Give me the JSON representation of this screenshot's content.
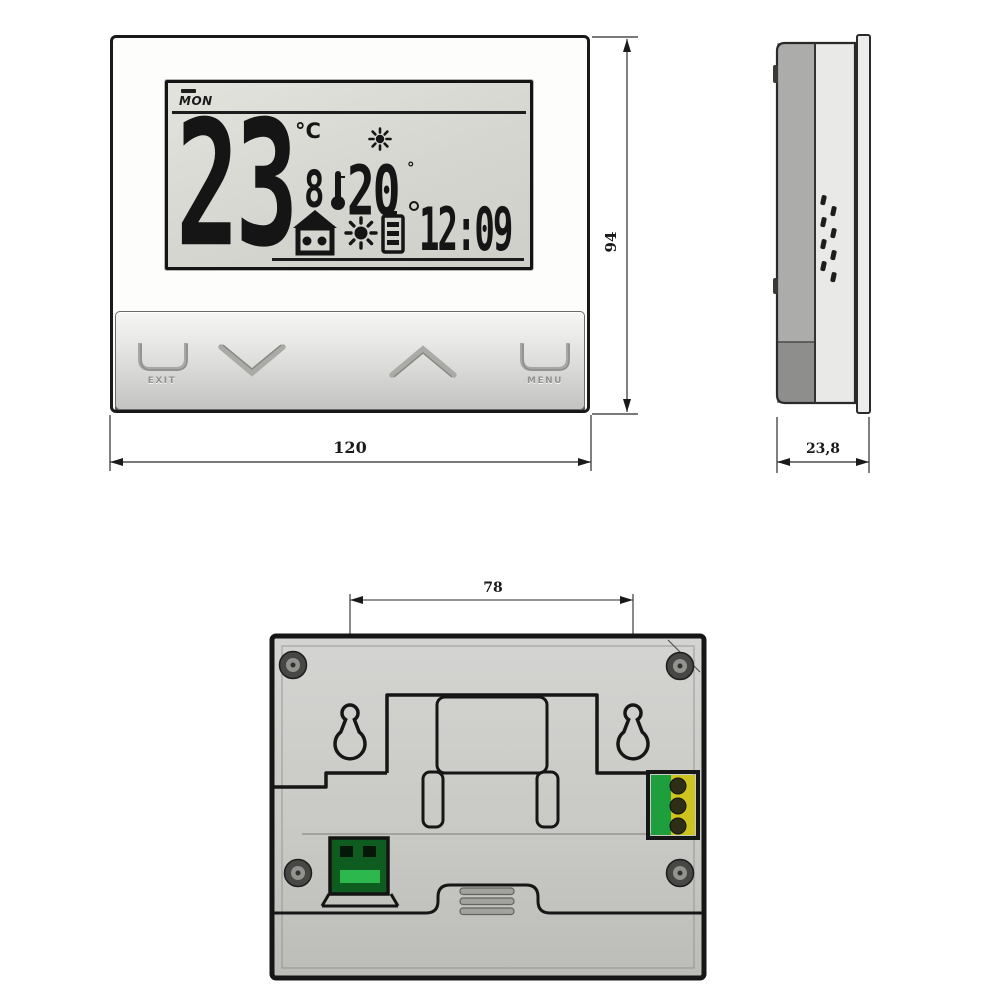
{
  "drawing_title": "thermostat-dimension-drawing",
  "front_view": {
    "lcd": {
      "day": "MON",
      "main_temp": "23",
      "main_temp_unit": "°C",
      "aux_digit": "8",
      "setpoint_temp": "20",
      "setpoint_unit": "°",
      "time": "12:09"
    },
    "buttons": {
      "exit": "EXIT",
      "menu": "MENU"
    }
  },
  "dimensions": {
    "front_width": "120",
    "front_height": "94",
    "side_depth": "23,8",
    "mount_hole_spacing": "78"
  },
  "icons": {
    "heat_indicator": "sun-icon",
    "comfort_mode": "house-icon",
    "heating_flame": "sun-burst-icon",
    "battery": "battery-icon",
    "thermometer": "thermometer-icon",
    "down": "chevron-down-icon",
    "up": "chevron-up-icon",
    "exit_key": "bracket-key-icon",
    "menu_key": "bracket-key-icon",
    "mounting": "keyhole-slot-icon",
    "fasteners": "screw-icon",
    "airflow": "vent-slots-icon"
  },
  "colors": {
    "line": "#1a1a1a",
    "lcd_background": "#d8d8d2",
    "body_gray": "#c9c9c7",
    "connector_green": "#1f9e3d",
    "connector_bright_green": "#2db84e",
    "terminal_yellow": "#cfc31f"
  }
}
